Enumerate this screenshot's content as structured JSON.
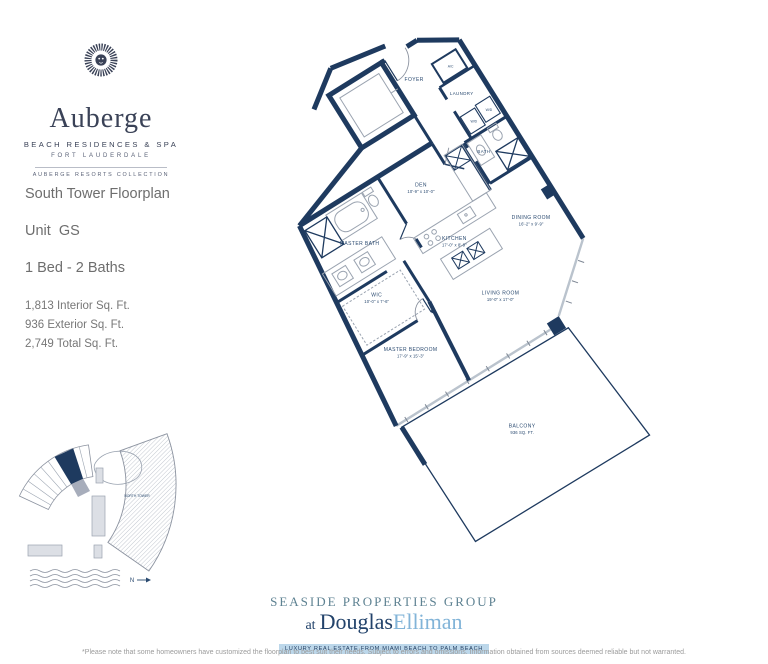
{
  "logo": {
    "brand": "Auberge",
    "tagline": "BEACH RESIDENCES & SPA",
    "location": "FORT LAUDERDALE",
    "collection": "AUBERGE RESORTS COLLECTION"
  },
  "info": {
    "title": "South Tower Floorplan",
    "unit": "Unit  GS",
    "beds": "1 Bed - 2 Baths",
    "interior": "1,813 Interior Sq. Ft.",
    "exterior": "936 Exterior Sq. Ft.",
    "total": "2,749 Total Sq. Ft."
  },
  "floorplan": {
    "rooms": [
      {
        "label": "FOYER",
        "dims": ""
      },
      {
        "label": "A/C",
        "dims": ""
      },
      {
        "label": "LAUNDRY",
        "dims": ""
      },
      {
        "label": "W/D",
        "dims": ""
      },
      {
        "label": "W/D",
        "dims": ""
      },
      {
        "label": "BATH",
        "dims": ""
      },
      {
        "label": "DEN",
        "dims": "10'-9\" x 10'-0\""
      },
      {
        "label": "KITCHEN",
        "dims": "17'-0\" x 8'-9\""
      },
      {
        "label": "DINING ROOM",
        "dims": "16'-2\" x 9'-9\""
      },
      {
        "label": "MASTER BATH",
        "dims": ""
      },
      {
        "label": "WIC",
        "dims": "10'-0\" x 7'-6\""
      },
      {
        "label": "LIVING ROOM",
        "dims": "19'-0\" x 17'-0\""
      },
      {
        "label": "MASTER BEDROOM",
        "dims": "17'-9\" x 15'-3\""
      },
      {
        "label": "BALCONY",
        "dims": "936 SQ. FT."
      }
    ]
  },
  "siteplan": {
    "north_tower": "NORTH TOWER",
    "compass": "N"
  },
  "footer": {
    "group": "SEASIDE PROPERTIES GROUP",
    "at": "at",
    "brand_primary": "Douglas",
    "brand_secondary": "Elliman",
    "bar": "LUXURY REAL ESTATE FROM MIAMI BEACH TO PALM BEACH",
    "disclaimer": "*Please note that some homeowners have customized the floorplan to best suit their needs. Subject to errors and omissions. Information obtained from sources deemed reliable but not warranted."
  },
  "colors": {
    "navy": "#1e3a5f",
    "logo_navy": "#3a4257",
    "teal": "#5e8292",
    "light_blue": "#82b4d8",
    "bar_bg": "#bcd7ea",
    "gray_text": "#6e6e6e"
  }
}
